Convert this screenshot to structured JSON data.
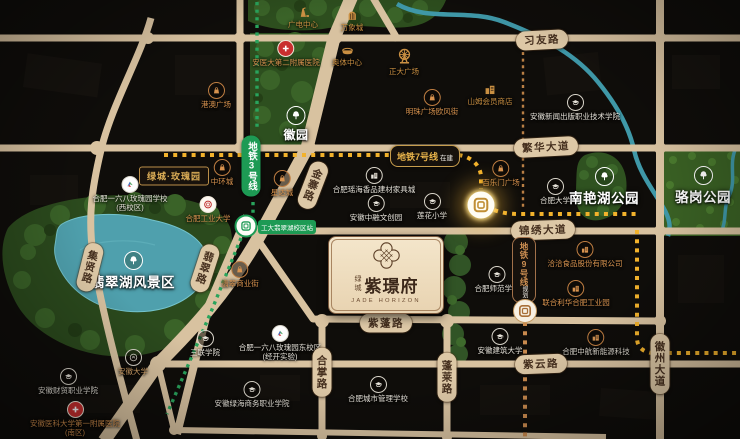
{
  "project": {
    "brand": "绿城",
    "name": "紫璟府",
    "name_en": "JADE HORIZON"
  },
  "roads": {
    "xiyou": "习友路",
    "fanhua": "繁华大道",
    "jinxiu": "锦绣大道",
    "zipeng": "紫蓬路",
    "ziyun": "紫云路",
    "jixian": "集贤路",
    "jinzhai": "金寨路",
    "feicui": "翡翠路",
    "hezhang": "合掌路",
    "penglai": "蓬莱路",
    "huizhou": "徽州大道"
  },
  "metro": {
    "line3": {
      "name": "地铁3号线",
      "station": "工大翡翠湖校区站"
    },
    "line7": {
      "name": "地铁7号线",
      "status": "在建"
    },
    "line9": {
      "name": "地铁9号线",
      "status": "规划"
    }
  },
  "parks": {
    "huiyuan": "徽园",
    "feicui_lake": "翡翠湖风景区",
    "nanyan": "南艳湖公园",
    "luogang": "骆岗公园"
  },
  "landmarks": {
    "rose_garden": "绿城·玫瑰园"
  },
  "pois": {
    "gangao": "港澳广场",
    "zhonghuan": "中环城",
    "xingda": "星达城",
    "feicui_street": "翡翠商业街",
    "bailemen": "百乐门广场",
    "mingzhu": "明珠广场欧风街",
    "qiaqia": "洽洽食品股份有限公司",
    "unilever": "联合利华合肥工业园",
    "guangdian": "广电中心",
    "wanxiang": "万象城",
    "aoti": "奥体中心",
    "sams": "山姆会员商店",
    "zhengda": "正大广场",
    "xinwen": "安徽新闻出版职业技术学院",
    "hefei_univ": "合肥大学",
    "lianhua": "莲花小学",
    "zhongrong": "安徽中融文创园",
    "yaohai": "合肥瑶海香品建材家具城",
    "shifan": "合肥师范学院",
    "jianzhu": "安徽建筑大学",
    "sanlian": "三联学院",
    "caimao": "安徽财贸职业学院",
    "lvhai": "安徽绿海商务职业学院",
    "chengguan": "合肥城市管理学校",
    "zhonghang": "合肥中航新能源科技",
    "school168w": "合肥一六八玫瑰园学校\n(西校区)",
    "school168e": "合肥一六八玫瑰园东校区\n(经开实验)",
    "eryuan": "安医大第二附属医院",
    "yiyuan_south": "安徽医科大学第一附属医院\n(南区)",
    "hfut": "合肥工业大学",
    "anda": "安徽大学"
  },
  "colors": {
    "road": "#d8c2a0",
    "park": "#2e4f1f",
    "water": "#4fa0ad",
    "metro3_green": "#1d9a54",
    "line7_yellow": "#f2b22c",
    "line9_bronze": "#c08448",
    "poi_orange": "#d8934f",
    "card_beige": "#eedcc2",
    "background": "#0f0d0a"
  }
}
